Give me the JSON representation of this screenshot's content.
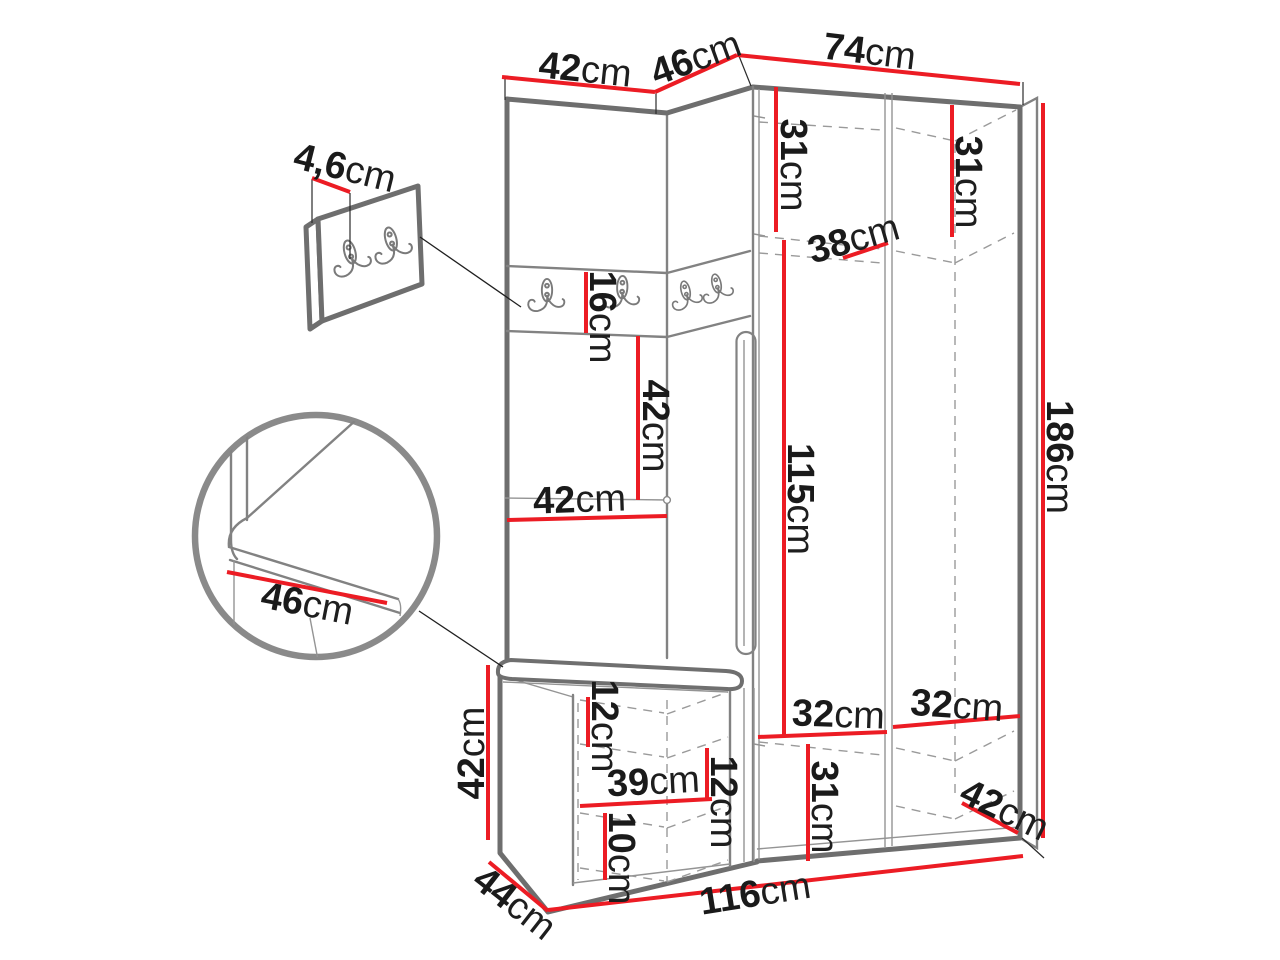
{
  "diagram_type": "furniture dimension drawing (hallway wardrobe set with bench and coat hooks)",
  "unit": "cm",
  "colors": {
    "dimension_line": "#ec1c24",
    "label_text": "#1a1a1a",
    "outline": "#6e6e6e",
    "dashed_interior": "#9a9a9a",
    "background": "#ffffff"
  },
  "dimensions": {
    "panel_width": {
      "value": "42",
      "unit": "cm"
    },
    "corner_width": {
      "value": "46",
      "unit": "cm"
    },
    "wardrobe_width": {
      "value": "74",
      "unit": "cm"
    },
    "hanger_strip_offset": {
      "value": "4,6",
      "unit": "cm"
    },
    "left_top_shelf": {
      "value": "31",
      "unit": "cm"
    },
    "right_top_shelf": {
      "value": "31",
      "unit": "cm"
    },
    "rail_depth": {
      "value": "38",
      "unit": "cm"
    },
    "hook_strip_height": {
      "value": "16",
      "unit": "cm"
    },
    "mid_section_height": {
      "value": "42",
      "unit": "cm"
    },
    "mid_section_width": {
      "value": "42",
      "unit": "cm"
    },
    "hanging_space_height": {
      "value": "115",
      "unit": "cm"
    },
    "total_height": {
      "value": "186",
      "unit": "cm"
    },
    "seat_depth": {
      "value": "46",
      "unit": "cm"
    },
    "bench_height": {
      "value": "42",
      "unit": "cm"
    },
    "bench_top_clearance": {
      "value": "12",
      "unit": "cm"
    },
    "bench_shelf_width": {
      "value": "39",
      "unit": "cm"
    },
    "bench_side_clearance": {
      "value": "12",
      "unit": "cm"
    },
    "bench_bottom_clearance": {
      "value": "10",
      "unit": "cm"
    },
    "left_shelf_width": {
      "value": "32",
      "unit": "cm"
    },
    "right_shelf_width": {
      "value": "32",
      "unit": "cm"
    },
    "bottom_shelf_height": {
      "value": "31",
      "unit": "cm"
    },
    "wardrobe_depth": {
      "value": "42",
      "unit": "cm"
    },
    "bench_depth": {
      "value": "44",
      "unit": "cm"
    },
    "total_width": {
      "value": "116",
      "unit": "cm"
    }
  }
}
